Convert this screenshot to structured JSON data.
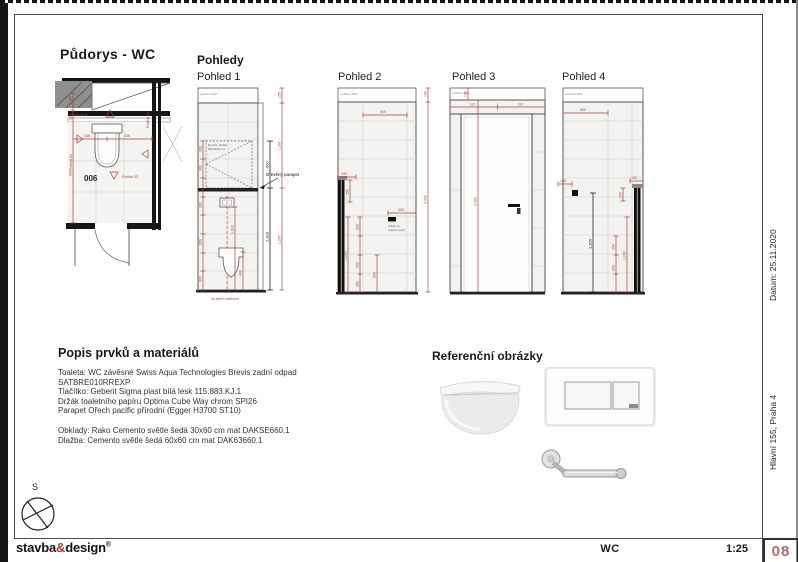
{
  "header": {
    "plan_title": "Půdorys - WC",
    "views_title": "Pohledy"
  },
  "plan": {
    "room_number": "006",
    "marker01": "Pohled 01",
    "marker02": "Pohled 02",
    "marker03": "Pohled 03",
    "marker04": "Pohled 04",
    "dim_380": "380",
    "dim_180": "180",
    "dim_600": "600",
    "dim_435a": "435",
    "dim_435b": "435"
  },
  "pohled1": {
    "title": "Pohled 1",
    "ceiling": "podhled SDK",
    "dim_150": "150",
    "dim_1200": "1,200",
    "dim_600": "600",
    "dim_1300": "1,300",
    "dim_1000": "1,000",
    "dim_400": "400",
    "dim_300": "300",
    "revizni_line1": "Revizní dvířka",
    "revizni_line2": "600x600 mm",
    "parapet_label": "Dřevěný parapet",
    "note": "na střed místnosti"
  },
  "pohled2": {
    "title": "Pohled 2",
    "ceiling": "podhled SDK",
    "dim_600": "600",
    "dim_150": "150",
    "dim_2400": "2,400",
    "dim_430": "430",
    "dim_350": "350",
    "dim_1200": "1,200",
    "dim_300": "300",
    "holder_line1": "držák na",
    "holder_line2": "toaletní papír"
  },
  "pohled3": {
    "title": "Pohled 3",
    "ceiling": "podhled SDK",
    "dim_100": "100",
    "dim_half": "1/2",
    "dim_2400": "2,400"
  },
  "pohled4": {
    "title": "Pohled 4",
    "ceiling": "podhled SDK",
    "dim_600": "600",
    "dim_150": "150",
    "dim_200": "200",
    "dim_1300": "1,300",
    "dim_1200": "1,200",
    "dim_300": "300"
  },
  "materials": {
    "title": "Popis prvků a materiálů",
    "lines": [
      "Toaleta: WC závěsné Swiss Aqua Technologies Brevis zadní odpad",
      "SATBRE010RREXP",
      "Tlačítko: Geberit Sigma plast bílá lesk 115.883.KJ.1",
      "Držák toaletního papíru Optima Cube Way chrom SPI26",
      "Parapet Ořech pacific přírodní (Egger H3700 ST10)",
      "Obklady: Rako Cemento světle šedá 30x60 cm mat DAKSE660.1",
      "Dlažba: Cemento světle šedá 60x60 cm mat DAK63660.1"
    ]
  },
  "reference": {
    "title": "Referenční obrázky"
  },
  "titleblock": {
    "drawing_name": "WC",
    "scale": "1:25",
    "sheet": "08",
    "date": "Datum: 25.11.2020",
    "address": "Hlavní 155, Praha 4"
  },
  "logo": {
    "word1": "stavba",
    "amp": "&",
    "word2": "design",
    "reg": "®"
  },
  "compass": {
    "north": "S"
  },
  "colors": {
    "dim_red": "#a5403c",
    "sheet_pink": "#b5686d",
    "logo_red": "#b03a2e"
  }
}
